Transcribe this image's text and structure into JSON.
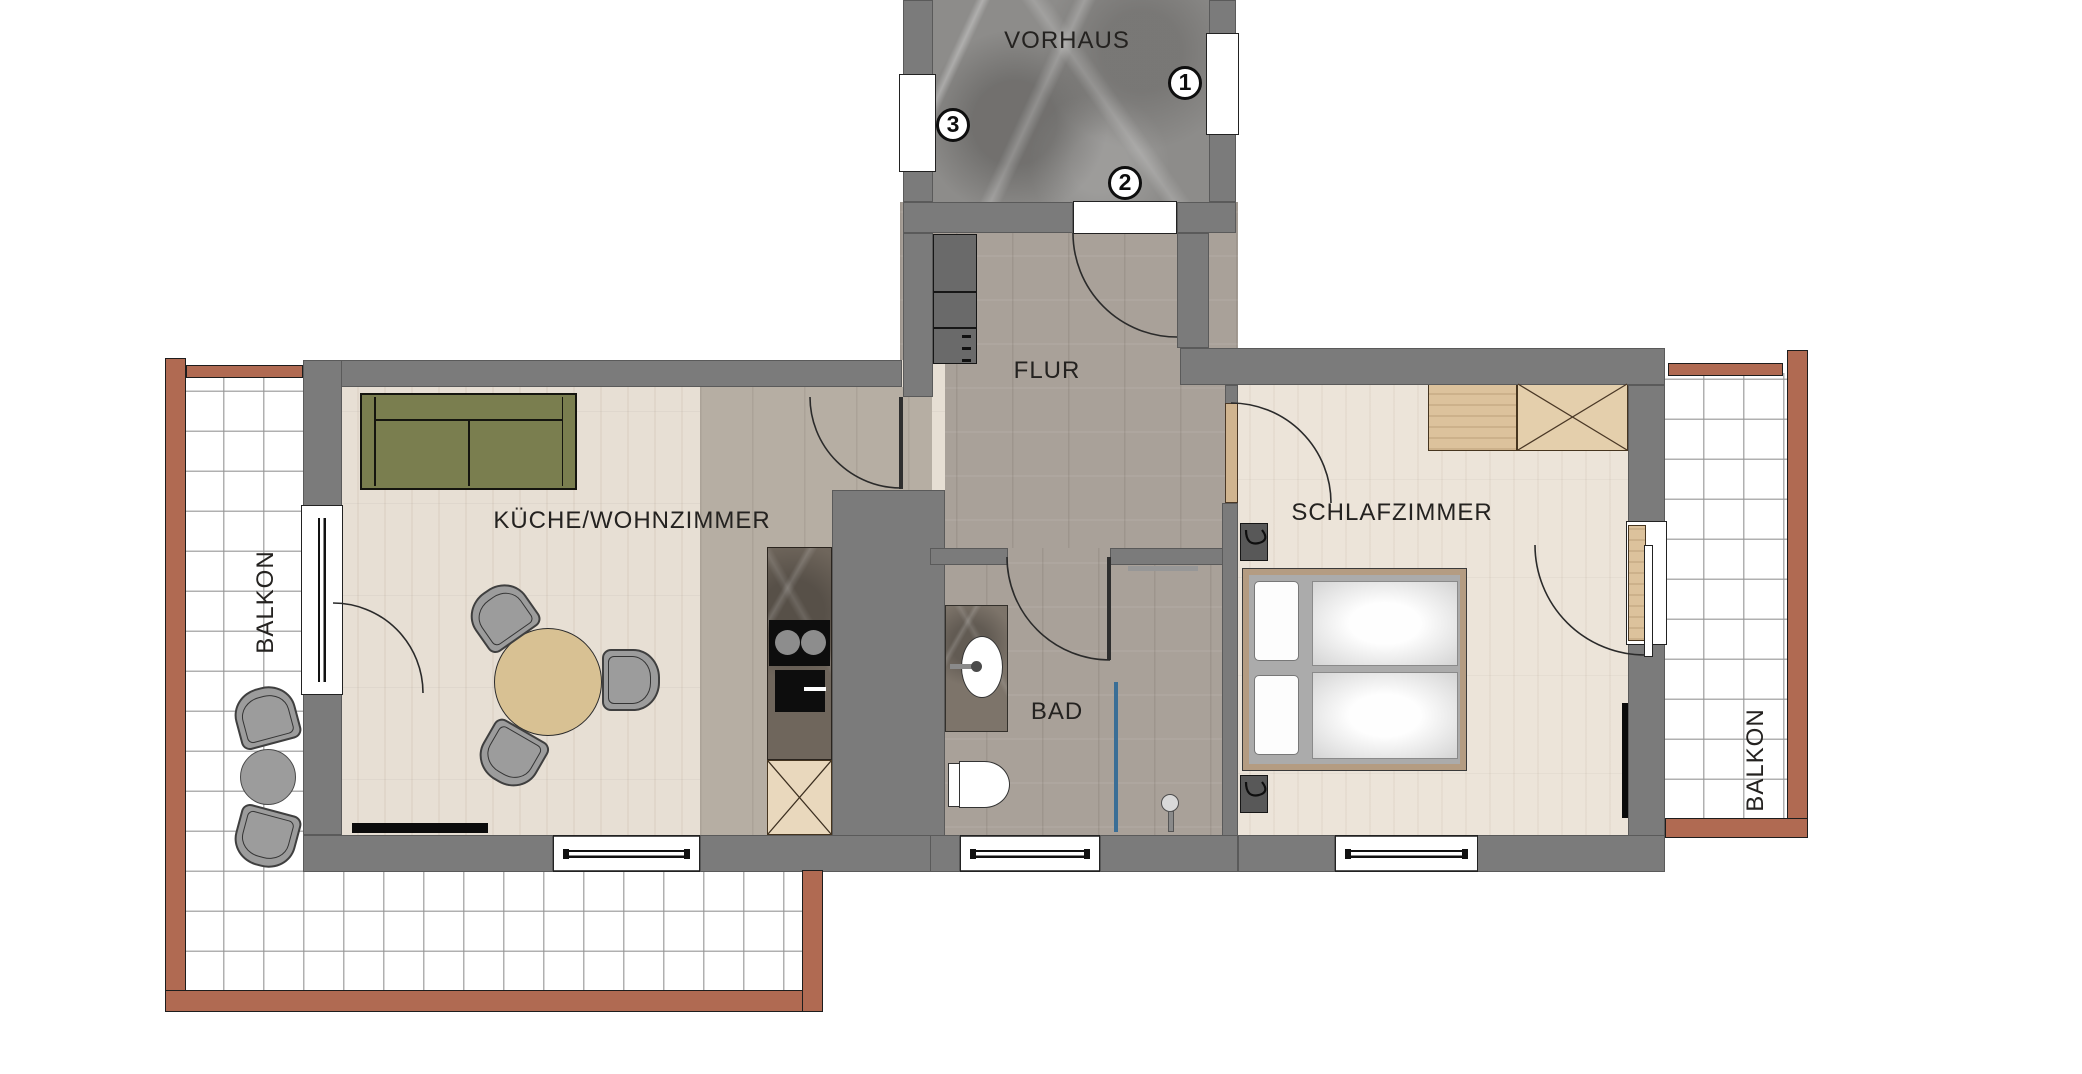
{
  "rooms": {
    "vorhaus": {
      "label": "VORHAUS"
    },
    "flur": {
      "label": "FLUR"
    },
    "kueche_wohnzimmer": {
      "label": "KÜCHE/WOHNZIMMER"
    },
    "bad": {
      "label": "BAD"
    },
    "schlafzimmer": {
      "label": "SCHLAFZIMMER"
    },
    "balkon_left": {
      "label": "BALKON"
    },
    "balkon_right": {
      "label": "BALKON"
    }
  },
  "markers": {
    "m1": {
      "label": "1"
    },
    "m2": {
      "label": "2"
    },
    "m3": {
      "label": "3"
    }
  },
  "colors": {
    "wall": "#7b7b7b",
    "railing": "#b06a52",
    "sofa": "#7a7e4f",
    "shower_glass": "#3a6e96",
    "floor_light_wood": "#e7dfd4",
    "floor_gray_wood": "#a9a199",
    "floor_kitchen": "#b6aea3",
    "marble_floor": "#8d8c8a",
    "counter_marble": "#6f665c",
    "table_wood": "#d8c193",
    "chair_gray": "#9c9c9c",
    "tile_line": "#bcbcbc"
  }
}
